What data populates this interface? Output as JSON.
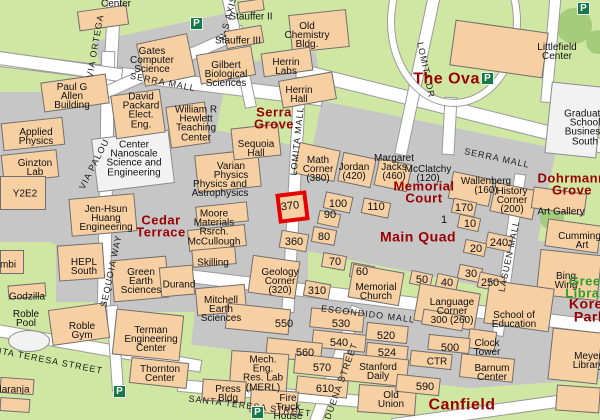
{
  "map": {
    "title": "campus map",
    "parking_glyph": "P",
    "highlight": {
      "label": "370"
    },
    "colors": {
      "lawn": "#cfe7a3",
      "paved": "#c6c6c6",
      "building": "#f6cfa3",
      "road": "#ffffff",
      "area_label": "#990000",
      "library_label": "#2f9e2f",
      "highlight_box": "#e60000",
      "parking": "#17784a"
    },
    "streets": [
      {
        "name": "via-ortega",
        "text": "VIA ORTEGA",
        "x": 95,
        "y": 46,
        "rot": -80
      },
      {
        "name": "ns-axis",
        "text": "N-S AXIS",
        "x": 228,
        "y": 18,
        "rot": -75
      },
      {
        "name": "lomita-dr",
        "text": "LOMITA DR",
        "x": 426,
        "y": 70,
        "rot": 78
      },
      {
        "name": "serra-mall-west",
        "text": "SERRA MALL",
        "x": 163,
        "y": 82,
        "rot": 11
      },
      {
        "name": "serra-mall-east",
        "text": "SERRA MALL",
        "x": 497,
        "y": 158,
        "rot": 12
      },
      {
        "name": "lomita-mall",
        "text": "LOMITA MALL",
        "x": 297,
        "y": 141,
        "rot": -84
      },
      {
        "name": "via-palou",
        "text": "VIA PALOU",
        "x": 94,
        "y": 164,
        "rot": -63
      },
      {
        "name": "sequoia-way",
        "text": "SEQUOIA WAY",
        "x": 111,
        "y": 271,
        "rot": -78
      },
      {
        "name": "escondido-mall",
        "text": "ESCONDIDO MALL",
        "x": 368,
        "y": 314,
        "rot": 7
      },
      {
        "name": "lasuen-mall",
        "text": "LASUEN MALL",
        "x": 509,
        "y": 256,
        "rot": -78
      },
      {
        "name": "duena-street",
        "text": "DUENA STREET",
        "x": 341,
        "y": 381,
        "rot": -70
      },
      {
        "name": "santa-teresa-street-west",
        "text": "SANTA TERESA STREET",
        "x": 42,
        "y": 359,
        "rot": 11
      },
      {
        "name": "santa-teresa-street-east",
        "text": "SANTA TERESA STREET",
        "x": 250,
        "y": 406,
        "rot": 7
      }
    ],
    "buildings": [
      {
        "name": "center",
        "lines": [
          "Center"
        ],
        "x": 116,
        "y": 4
      },
      {
        "name": "gates-computer-science",
        "lines": [
          "Gates",
          "Computer",
          "Science"
        ],
        "x": 152,
        "y": 61
      },
      {
        "name": "stauffer-ii",
        "lines": [
          "Stauffer II"
        ],
        "x": 251,
        "y": 17
      },
      {
        "name": "stauffer-iii",
        "lines": [
          "Stauffer III"
        ],
        "x": 238,
        "y": 41
      },
      {
        "name": "old-chemistry-bldg",
        "lines": [
          "Old",
          "Chemistry",
          "Bldg."
        ],
        "x": 307,
        "y": 36
      },
      {
        "name": "herrin-labs",
        "lines": [
          "Herrin",
          "Labs"
        ],
        "x": 286,
        "y": 67
      },
      {
        "name": "herrin-hall",
        "lines": [
          "Herrin",
          "Hall"
        ],
        "x": 299,
        "y": 95
      },
      {
        "name": "gilbert-biological-sciences",
        "lines": [
          "Gilbert",
          "Biological",
          "Sciences"
        ],
        "x": 226,
        "y": 75
      },
      {
        "name": "paul-g-allen-building",
        "lines": [
          "Paul G",
          "Allen",
          "Building"
        ],
        "x": 72,
        "y": 97
      },
      {
        "name": "david-packard-elect-eng",
        "lines": [
          "David",
          "Packard",
          "Elect.",
          "Eng."
        ],
        "x": 141,
        "y": 111
      },
      {
        "name": "william-r-hewlett-teaching-center",
        "lines": [
          "William R",
          "Hewlett",
          "Teaching",
          "Center"
        ],
        "x": 196,
        "y": 124
      },
      {
        "name": "applied-physics",
        "lines": [
          "Applied",
          "Physics"
        ],
        "x": 36,
        "y": 137
      },
      {
        "name": "ginzton-lab",
        "lines": [
          "Ginzton",
          "Lab"
        ],
        "x": 35,
        "y": 168
      },
      {
        "name": "y2e2",
        "lines": [
          "Y2E2"
        ],
        "x": 25,
        "y": 194
      },
      {
        "name": "center-nanoscale-science-engineering",
        "lines": [
          "Center",
          "Nanoscale",
          "Science and",
          "Engineering"
        ],
        "x": 134,
        "y": 159
      },
      {
        "name": "sequoia-hall",
        "lines": [
          "Sequoia",
          "Hall"
        ],
        "x": 256,
        "y": 149
      },
      {
        "name": "varian-physics",
        "lines": [
          "Varian",
          "Physics"
        ],
        "x": 231,
        "y": 171
      },
      {
        "name": "physics-and-astrophysics",
        "lines": [
          "Physics and",
          "Astrophysics"
        ],
        "x": 220,
        "y": 189
      },
      {
        "name": "math-corner",
        "lines": [
          "Math",
          "Corner",
          "(380)"
        ],
        "x": 318,
        "y": 170
      },
      {
        "name": "jordan",
        "lines": [
          "Jordan",
          "(420)"
        ],
        "x": 354,
        "y": 172
      },
      {
        "name": "margaret-jacks",
        "lines": [
          "Margaret",
          "Jacks",
          "(460)"
        ],
        "x": 394,
        "y": 168
      },
      {
        "name": "mcclatchy",
        "lines": [
          "McClatchy",
          "(120)"
        ],
        "x": 428,
        "y": 174
      },
      {
        "name": "wallenberg",
        "lines": [
          "Wallenberg",
          "(160)"
        ],
        "x": 486,
        "y": 186
      },
      {
        "name": "history-corner",
        "lines": [
          "History",
          "Corner",
          "(200)"
        ],
        "x": 512,
        "y": 201
      },
      {
        "name": "moore-materials-rsrch-mccullough",
        "lines": [
          "Moore",
          "Materials",
          "Rsrch.",
          "McCullough"
        ],
        "x": 214,
        "y": 228
      },
      {
        "name": "jen-hsun-huang-engineering",
        "lines": [
          "Jen-Hsun",
          "Huang",
          "Engineering"
        ],
        "x": 106,
        "y": 219
      },
      {
        "name": "hepl-south",
        "lines": [
          "HEPL",
          "South"
        ],
        "x": 84,
        "y": 267
      },
      {
        "name": "green-earth-sciences",
        "lines": [
          "Green",
          "Earth",
          "Sciences"
        ],
        "x": 141,
        "y": 282
      },
      {
        "name": "durand",
        "lines": [
          "Durand"
        ],
        "x": 179,
        "y": 285
      },
      {
        "name": "skilling",
        "lines": [
          "Skilling"
        ],
        "x": 213,
        "y": 263
      },
      {
        "name": "mitchell-earth-sciences",
        "lines": [
          "Mitchell",
          "Earth",
          "Sciences"
        ],
        "x": 221,
        "y": 310
      },
      {
        "name": "geology-corner",
        "lines": [
          "Geology",
          "Corner",
          "(320)"
        ],
        "x": 280,
        "y": 282
      },
      {
        "name": "memorial-church",
        "lines": [
          "Memorial",
          "Church"
        ],
        "x": 376,
        "y": 292
      },
      {
        "name": "language-corner",
        "lines": [
          "Language",
          "Corner",
          "300 (260)"
        ],
        "x": 452,
        "y": 312
      },
      {
        "name": "school-of-education",
        "lines": [
          "School of",
          "Education"
        ],
        "x": 514,
        "y": 320
      },
      {
        "name": "clock-tower",
        "lines": [
          "Clock",
          "Tower"
        ],
        "x": 487,
        "y": 348
      },
      {
        "name": "barnum-center",
        "lines": [
          "Barnum",
          "Center"
        ],
        "x": 492,
        "y": 373
      },
      {
        "name": "meyer-library",
        "lines": [
          "Meyer",
          "Library"
        ],
        "x": 588,
        "y": 361
      },
      {
        "name": "art-gallery",
        "lines": [
          "Art Gallery"
        ],
        "x": 561,
        "y": 212
      },
      {
        "name": "cummings-art",
        "lines": [
          "Cummings",
          "Art"
        ],
        "x": 582,
        "y": 241
      },
      {
        "name": "bing-wing",
        "lines": [
          "Bing",
          "Wing"
        ],
        "x": 566,
        "y": 281
      },
      {
        "name": "littlefield-center",
        "lines": [
          "Littlefield",
          "Center"
        ],
        "x": 557,
        "y": 52
      },
      {
        "name": "graduate-school-business-south",
        "lines": [
          "Graduate",
          "School",
          "Business",
          "South"
        ],
        "x": 585,
        "y": 128
      },
      {
        "name": "terman-engineering-center",
        "lines": [
          "Terman",
          "Engineering",
          "Center"
        ],
        "x": 151,
        "y": 340
      },
      {
        "name": "thornton-center",
        "lines": [
          "Thornton",
          "Center"
        ],
        "x": 160,
        "y": 374
      },
      {
        "name": "roble-gym",
        "lines": [
          "Roble",
          "Gym"
        ],
        "x": 82,
        "y": 331
      },
      {
        "name": "roble-pool",
        "lines": [
          "Roble",
          "Pool"
        ],
        "x": 26,
        "y": 319
      },
      {
        "name": "godzilla",
        "lines": [
          "Godzilla"
        ],
        "x": 27,
        "y": 297
      },
      {
        "name": "mbi",
        "lines": [
          "mbi"
        ],
        "x": 8,
        "y": 265
      },
      {
        "name": "naranja",
        "lines": [
          "Naranja"
        ],
        "x": 12,
        "y": 390
      },
      {
        "name": "mech-eng-res-lab-merl",
        "lines": [
          "Mech.",
          "Eng.",
          "Res. Lab",
          "(MERL)"
        ],
        "x": 263,
        "y": 374
      },
      {
        "name": "press-bldg",
        "lines": [
          "Press",
          "Bldg"
        ],
        "x": 228,
        "y": 394
      },
      {
        "name": "fire-truck-house",
        "lines": [
          "Fire",
          "Truck",
          "House"
        ],
        "x": 288,
        "y": 408
      },
      {
        "name": "stanford-daily",
        "lines": [
          "Stanford",
          "Daily"
        ],
        "x": 378,
        "y": 372
      },
      {
        "name": "old-union",
        "lines": [
          "Old",
          "Union"
        ],
        "x": 391,
        "y": 400
      },
      {
        "name": "ctr",
        "lines": [
          "CTR"
        ],
        "x": 437,
        "y": 362
      }
    ],
    "numbers": [
      {
        "text": "100",
        "x": 338,
        "y": 204
      },
      {
        "text": "110",
        "x": 376,
        "y": 207
      },
      {
        "text": "90",
        "x": 330,
        "y": 215
      },
      {
        "text": "360",
        "x": 294,
        "y": 242
      },
      {
        "text": "80",
        "x": 324,
        "y": 237
      },
      {
        "text": "70",
        "x": 335,
        "y": 262
      },
      {
        "text": "60",
        "x": 362,
        "y": 272
      },
      {
        "text": "310",
        "x": 317,
        "y": 291
      },
      {
        "text": "170",
        "x": 464,
        "y": 208
      },
      {
        "text": "1",
        "x": 444,
        "y": 220
      },
      {
        "text": "10",
        "x": 470,
        "y": 224
      },
      {
        "text": "240",
        "x": 499,
        "y": 243
      },
      {
        "text": "20",
        "x": 476,
        "y": 249
      },
      {
        "text": "30",
        "x": 471,
        "y": 274
      },
      {
        "text": "50",
        "x": 422,
        "y": 280
      },
      {
        "text": "40",
        "x": 447,
        "y": 283
      },
      {
        "text": "250",
        "x": 490,
        "y": 283
      },
      {
        "text": "550",
        "x": 284,
        "y": 324
      },
      {
        "text": "530",
        "x": 341,
        "y": 324
      },
      {
        "text": "540",
        "x": 339,
        "y": 343
      },
      {
        "text": "520",
        "x": 386,
        "y": 336
      },
      {
        "text": "524",
        "x": 387,
        "y": 353
      },
      {
        "text": "560",
        "x": 305,
        "y": 353
      },
      {
        "text": "570",
        "x": 322,
        "y": 368
      },
      {
        "text": "610",
        "x": 325,
        "y": 389
      },
      {
        "text": "590",
        "x": 425,
        "y": 387
      },
      {
        "text": "500",
        "x": 450,
        "y": 348
      }
    ],
    "areas": [
      {
        "name": "the-oval",
        "lines": [
          "The Oval"
        ],
        "x": 449,
        "y": 79,
        "fs": 16,
        "color": "#990000"
      },
      {
        "name": "serra-grove",
        "lines": [
          "Serra",
          "Grove"
        ],
        "x": 274,
        "y": 119,
        "fs": 13,
        "color": "#990000"
      },
      {
        "name": "cedar-terrace",
        "lines": [
          "Cedar",
          "Terrace"
        ],
        "x": 161,
        "y": 227,
        "fs": 13,
        "color": "#990000"
      },
      {
        "name": "memorial-court",
        "lines": [
          "Memorial",
          "Court"
        ],
        "x": 424,
        "y": 193,
        "fs": 13,
        "color": "#990000"
      },
      {
        "name": "main-quad",
        "lines": [
          "Main Quad"
        ],
        "x": 418,
        "y": 237,
        "fs": 14,
        "color": "#990000"
      },
      {
        "name": "dohrmann-grove",
        "lines": [
          "Dohrmann",
          "Grove"
        ],
        "x": 572,
        "y": 185,
        "fs": 13,
        "color": "#990000"
      },
      {
        "name": "canfield",
        "lines": [
          "Canfield"
        ],
        "x": 462,
        "y": 405,
        "fs": 16,
        "color": "#990000"
      },
      {
        "name": "korea-park",
        "lines": [
          "Korea",
          "Park"
        ],
        "x": 590,
        "y": 311,
        "fs": 14,
        "color": "#990000"
      },
      {
        "name": "green-library",
        "lines": [
          "Green",
          "Library"
        ],
        "x": 589,
        "y": 288,
        "fs": 13,
        "color": "#2f9e2f"
      }
    ],
    "parking_positions": [
      {
        "name": "parking-gates",
        "x": 190,
        "y": 17
      },
      {
        "name": "parking-northeast",
        "x": 577,
        "y": 2
      },
      {
        "name": "parking-oval",
        "x": 481,
        "y": 72
      },
      {
        "name": "parking-roble",
        "x": 113,
        "y": 385
      },
      {
        "name": "parking-santa-teresa",
        "x": 251,
        "y": 406
      }
    ]
  }
}
